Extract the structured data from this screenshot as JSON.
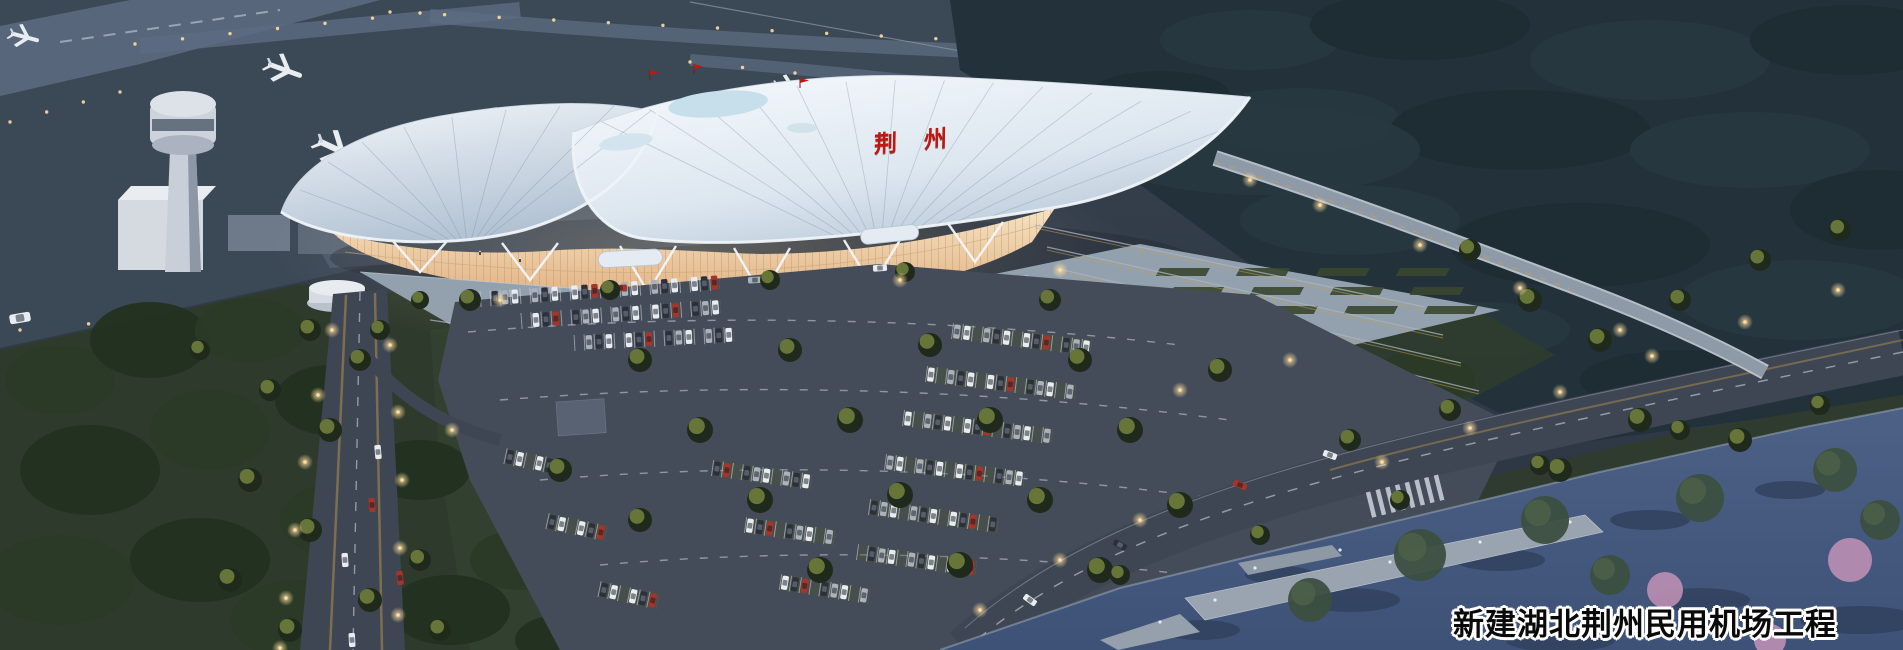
{
  "caption": {
    "text": "新建湖北荆州民用机场工程"
  },
  "terminal_sign": {
    "text": "荆州"
  },
  "palette": {
    "tarmac": "#3b4856",
    "taxiway": "#5e6c82",
    "forest-dark": "#22313a",
    "roof-white": "#f3f7fb",
    "roof-shade": "#b2c2d3",
    "glass-glow-top": "#f6e3c2",
    "glass-glow-bottom": "#e0ae7e",
    "plaza": "#93a0ae",
    "asphalt": "#454c59",
    "road": "#3e4553",
    "lane-glow": "#c9a050",
    "grass": "#2e3a2c",
    "water": "#4d6187",
    "water-deep": "#3e5278",
    "pier": "#9aa4b0",
    "blossom-pink": "#bd8fb4",
    "car-white": "#e9edf1",
    "car-silver": "#aab2bc",
    "car-dark": "#2b303a",
    "car-red": "#a53528",
    "sign-red": "#c2170f",
    "caption-ink": "#0a0a0a",
    "caption-outline": "#ffffff",
    "streetlamp": "#ffdca2",
    "tower-body": "#c9cfd8",
    "plane-white": "#e8edf2"
  }
}
